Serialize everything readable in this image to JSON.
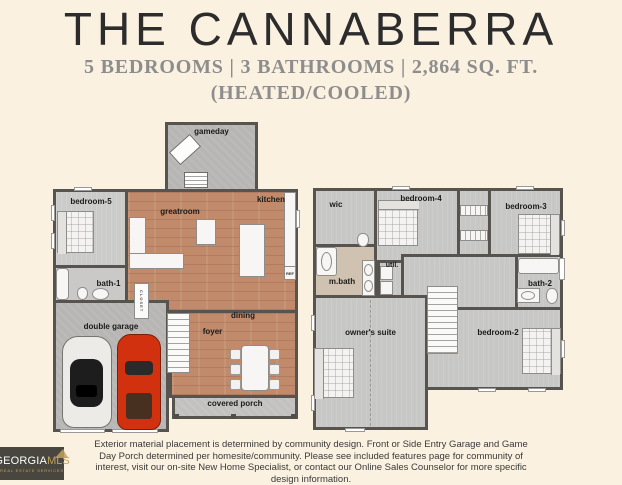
{
  "header": {
    "title": "THE CANNABERRA",
    "subtitle_line1": "5 BEDROOMS | 3 BATHROOMS | 2,864 SQ. FT.",
    "subtitle_line2": "(HEATED/COOLED)"
  },
  "floorplan": {
    "first_floor": {
      "rooms": {
        "gameday": "gameday",
        "bedroom5": "bedroom-5",
        "greatroom": "greatroom",
        "kitchen": "kitchen",
        "bath1": "bath-1",
        "closet": "CLOSET",
        "double_garage": "double garage",
        "foyer": "foyer",
        "dining": "dining",
        "covered_porch": "covered porch",
        "ref": "REF"
      }
    },
    "second_floor": {
      "rooms": {
        "wic": "wic",
        "bedroom4": "bedroom-4",
        "bedroom3": "bedroom-3",
        "mbath": "m.bath",
        "util": "util.",
        "bath2": "bath-2",
        "owners_suite": "owner's suite",
        "bedroom2": "bedroom-2"
      }
    }
  },
  "disclaimer": "Exterior material placement is determined by community design. Front or Side Entry Garage and Game Day Porch determined per homesite/community. Please see included features page for community of interest, visit our on-site New Home Specialist, or contact our Online Sales Counselor for more specific design information.",
  "logo": {
    "name_part1": "GEORGIA",
    "name_part2": "MLS",
    "tagline": "REAL ESTATE SERVICES"
  },
  "colors": {
    "background": "#faf1e1",
    "title_text": "#2c2c2c",
    "subtitle_text": "#8d8d8d",
    "wall": "#57544f",
    "wood_floor": "#c08a6b",
    "carpet": "#cbcbc9",
    "concrete": "#b7b6b4",
    "master_bath_floor": "#d0c2b1",
    "red_car": "#d23110",
    "logo_background": "#49463f",
    "logo_gold": "#c2a15c"
  }
}
